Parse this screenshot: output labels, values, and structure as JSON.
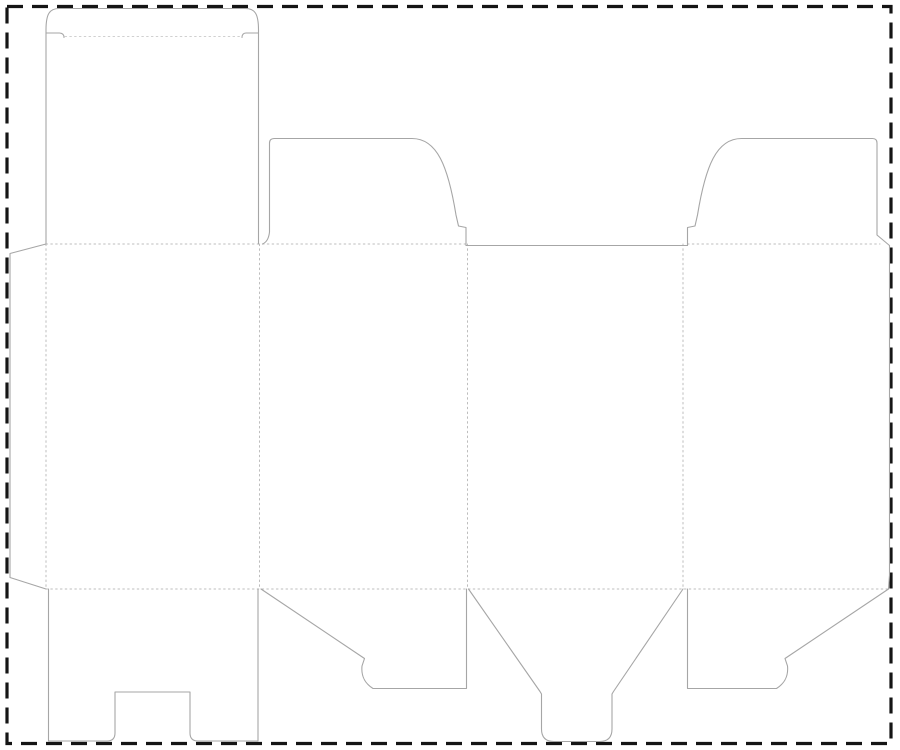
{
  "document": {
    "title": "Folding carton box dieline template",
    "type": "packaging-dieline",
    "description": "Die-cut layout for a tuck-top snap-lock-bottom carton: four body panels, glue flap, tuck lid with slit locks, two dust flaps, notched bottom panel, two snap-lock flaps and a rounded tongue flap."
  },
  "canvas": {
    "width": 900,
    "height": 750,
    "background": "#ffffff"
  },
  "colors": {
    "background": "#ffffff",
    "cut_line": "#a6a6a6",
    "fold_line": "#bdbdbd",
    "tuck_fold_line": "#d0d0d0",
    "sheet_border": "#151515"
  },
  "legend": {
    "solid_line_meaning": "cut",
    "dotted_line_meaning": "crease / fold",
    "dashed_line_meaning": "sheet boundary"
  },
  "dimensions_px": {
    "sheet_border": {
      "left": 7,
      "top": 6.5,
      "right": 891,
      "bottom": 743.5
    },
    "body_fold_top_y": 244,
    "body_fold_bottom_y": 589,
    "panel_edges_x": [
      46,
      259.5,
      467.5,
      683,
      889.5
    ],
    "tuck_fold_y": 36.5,
    "tuck_top_y": 8.5,
    "dust_flap_top_y": 138.5,
    "bottom_flap_bottom_y": 741,
    "glue_flap_left_x": 10
  },
  "parts": [
    {
      "name": "glue-flap",
      "attached_to": "panel-1-left-edge"
    },
    {
      "name": "panel-1-back",
      "bbox": [
        46,
        244,
        259.5,
        589
      ]
    },
    {
      "name": "panel-2-side",
      "bbox": [
        259.5,
        244,
        467.5,
        589
      ]
    },
    {
      "name": "panel-3-front",
      "bbox": [
        467.5,
        244,
        683,
        589
      ]
    },
    {
      "name": "panel-4-side",
      "bbox": [
        683,
        244,
        889.5,
        589
      ]
    },
    {
      "name": "tuck-lid",
      "attached_to": "panel-1-top",
      "bbox": [
        46,
        8.5,
        258.5,
        244
      ]
    },
    {
      "name": "dust-flap-middle",
      "attached_to": "panel-2-top",
      "bbox": [
        262.5,
        138.5,
        466,
        244
      ]
    },
    {
      "name": "dust-flap-right",
      "attached_to": "panel-4-top",
      "bbox": [
        687.5,
        138.5,
        889.5,
        244
      ]
    },
    {
      "name": "bottom-flap-notched",
      "attached_to": "panel-1-bottom",
      "bbox": [
        48.5,
        589,
        258,
        741
      ]
    },
    {
      "name": "snap-lock-flap-left",
      "attached_to": "panel-2-bottom",
      "bbox": [
        261,
        589,
        466.5,
        688.5
      ]
    },
    {
      "name": "tongue-flap",
      "attached_to": "panel-3-bottom",
      "bbox": [
        468.5,
        589,
        683,
        741.5
      ]
    },
    {
      "name": "snap-lock-flap-right",
      "attached_to": "panel-4-bottom",
      "bbox": [
        687.5,
        589,
        888.5,
        688.5
      ]
    }
  ]
}
